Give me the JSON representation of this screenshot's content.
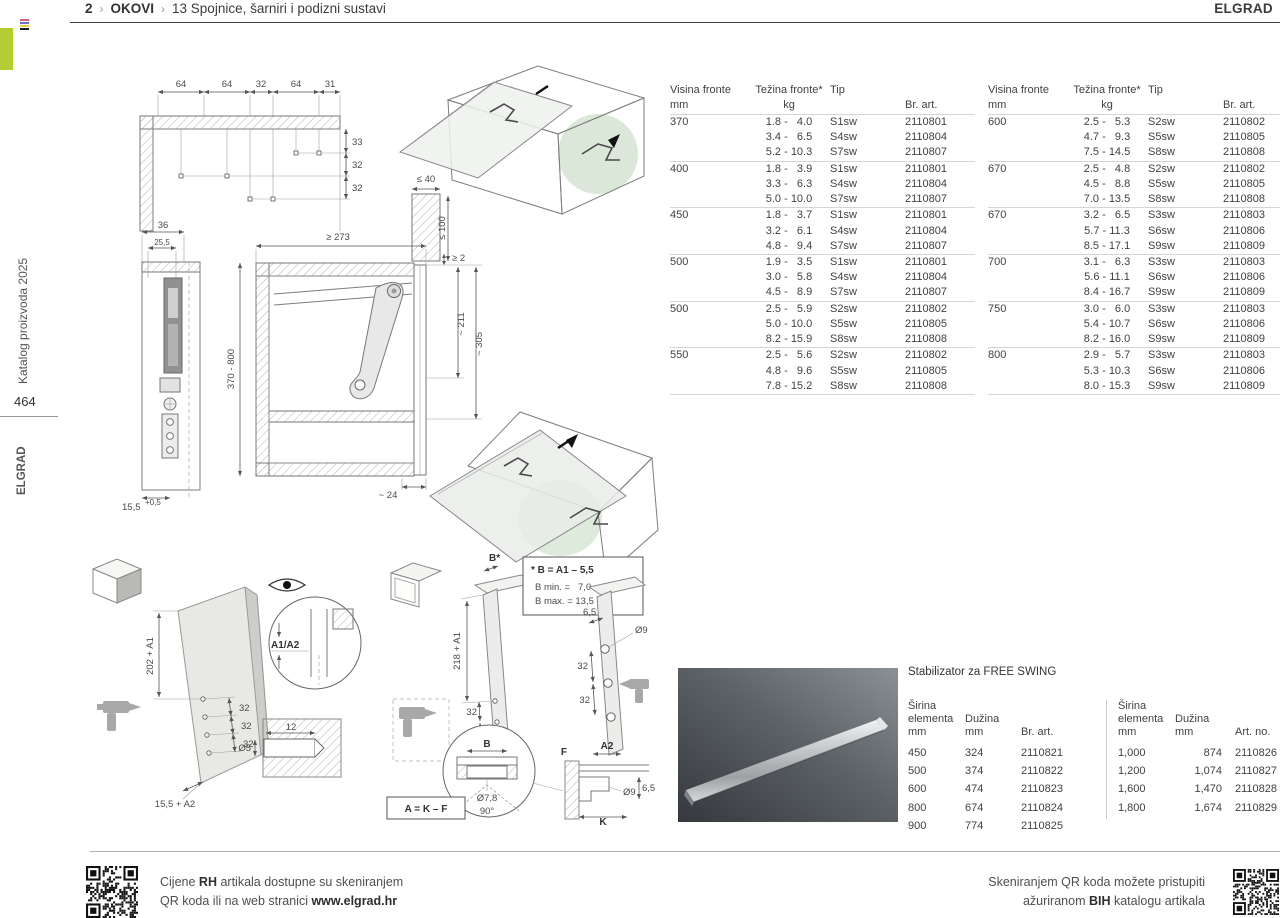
{
  "header": {
    "breadcrumb": {
      "page": "2",
      "sep1": "›",
      "section": "OKOVI",
      "sep2": "›",
      "title": "13  Spojnice, šarniri i podizni sustavi"
    },
    "brand": "ELGRAD"
  },
  "sidebar": {
    "catalog": "Katalog proizvoda 2025",
    "page_number": "464",
    "brand": "ELGRAD"
  },
  "hinge_tables": {
    "headers": {
      "visina": "Visina fronte",
      "visina_unit": "mm",
      "tezina": "Težina fronte*",
      "tezina_unit": "kg",
      "tip": "Tip",
      "art": "Br. art."
    },
    "left_groups": [
      {
        "visina": "370",
        "items": [
          [
            "1.8 -   4.0",
            "S1sw",
            "2110801"
          ],
          [
            "3.4 -   6.5",
            "S4sw",
            "2110804"
          ],
          [
            "5.2 - 10.3",
            "S7sw",
            "2110807"
          ]
        ]
      },
      {
        "visina": "400",
        "items": [
          [
            "1.8 -   3.9",
            "S1sw",
            "2110801"
          ],
          [
            "3.3 -   6.3",
            "S4sw",
            "2110804"
          ],
          [
            "5.0 - 10.0",
            "S7sw",
            "2110807"
          ]
        ]
      },
      {
        "visina": "450",
        "items": [
          [
            "1.8 -   3.7",
            "S1sw",
            "2110801"
          ],
          [
            "3.2 -   6.1",
            "S4sw",
            "2110804"
          ],
          [
            "4.8 -   9.4",
            "S7sw",
            "2110807"
          ]
        ]
      },
      {
        "visina": "500",
        "items": [
          [
            "1.9 -   3.5",
            "S1sw",
            "2110801"
          ],
          [
            "3.0 -   5.8",
            "S4sw",
            "2110804"
          ],
          [
            "4.5 -   8.9",
            "S7sw",
            "2110807"
          ]
        ]
      },
      {
        "visina": "500",
        "items": [
          [
            "2.5 -   5.9",
            "S2sw",
            "2110802"
          ],
          [
            "5.0 - 10.0",
            "S5sw",
            "2110805"
          ],
          [
            "8.2 - 15.9",
            "S8sw",
            "2110808"
          ]
        ]
      },
      {
        "visina": "550",
        "items": [
          [
            "2.5 -   5.6",
            "S2sw",
            "2110802"
          ],
          [
            "4.8 -   9.6",
            "S5sw",
            "2110805"
          ],
          [
            "7.8 - 15.2",
            "S8sw",
            "2110808"
          ]
        ]
      }
    ],
    "right_groups": [
      {
        "visina": "600",
        "items": [
          [
            "2.5 -   5.3",
            "S2sw",
            "2110802"
          ],
          [
            "4.7 -   9.3",
            "S5sw",
            "2110805"
          ],
          [
            "7.5 - 14.5",
            "S8sw",
            "2110808"
          ]
        ]
      },
      {
        "visina": "670",
        "items": [
          [
            "2.5 -   4.8",
            "S2sw",
            "2110802"
          ],
          [
            "4.5 -   8.8",
            "S5sw",
            "2110805"
          ],
          [
            "7.0 - 13.5",
            "S8sw",
            "2110808"
          ]
        ]
      },
      {
        "visina": "670",
        "items": [
          [
            "3.2 -   6.5",
            "S3sw",
            "2110803"
          ],
          [
            "5.7 - 11.3",
            "S6sw",
            "2110806"
          ],
          [
            "8.5 - 17.1",
            "S9sw",
            "2110809"
          ]
        ]
      },
      {
        "visina": "700",
        "items": [
          [
            "3.1 -   6.3",
            "S3sw",
            "2110803"
          ],
          [
            "5.6 - 11.1",
            "S6sw",
            "2110806"
          ],
          [
            "8.4 - 16.7",
            "S9sw",
            "2110809"
          ]
        ]
      },
      {
        "visina": "750",
        "items": [
          [
            "3.0 -   6.0",
            "S3sw",
            "2110803"
          ],
          [
            "5.4 - 10.7",
            "S6sw",
            "2110806"
          ],
          [
            "8.2 - 16.0",
            "S9sw",
            "2110809"
          ]
        ]
      },
      {
        "visina": "800",
        "items": [
          [
            "2.9 -   5.7",
            "S3sw",
            "2110803"
          ],
          [
            "5.3 - 10.3",
            "S6sw",
            "2110806"
          ],
          [
            "8.0 - 15.3",
            "S9sw",
            "2110809"
          ]
        ]
      }
    ]
  },
  "stabilizer": {
    "title": "Stabilizator za FREE SWING",
    "left_table": {
      "h_sirina_1": "Širina",
      "h_sirina_2": "elementa",
      "h_sirina_3": "mm",
      "h_duzina_1": "Dužina",
      "h_duzina_2": "mm",
      "h_art": "Br. art.",
      "rows": [
        [
          "450",
          "324",
          "2110821"
        ],
        [
          "500",
          "374",
          "2110822"
        ],
        [
          "600",
          "474",
          "2110823"
        ],
        [
          "800",
          "674",
          "2110824"
        ],
        [
          "900",
          "774",
          "2110825"
        ]
      ]
    },
    "right_table": {
      "h_sirina_1": "Širina",
      "h_sirina_2": "elementa",
      "h_sirina_3": "mm",
      "h_duzina_1": "Dužina",
      "h_duzina_2": "mm",
      "h_art": "Art. no.",
      "rows": [
        [
          "1,000",
          "874",
          "2110826"
        ],
        [
          "1,200",
          "1,074",
          "2110827"
        ],
        [
          "1,600",
          "1,470",
          "2110828"
        ],
        [
          "1,800",
          "1,674",
          "2110829"
        ]
      ]
    }
  },
  "drawings": {
    "corner": {
      "top": [
        "64",
        "64",
        "32",
        "64",
        "31"
      ],
      "right": [
        "33",
        "32",
        "32"
      ]
    },
    "side": {
      "d36": "36",
      "d255": "25,5",
      "d155": "15,5",
      "sup": "+0,5"
    },
    "front": {
      "width": "≥ 273",
      "height": "370 - 800",
      "wall": "≤ 40",
      "depth": "≤ 100",
      "gap": "≥ 2",
      "a211": "~ 211",
      "a305": "~ 305",
      "b24": "~ 24"
    },
    "drill_left": {
      "v": "202 + A1",
      "s1": "32",
      "s2": "32",
      "s3": "32",
      "bottom": "15,5 + A2",
      "detail": "A1/A2",
      "dia": "Ø5",
      "depth": "12"
    },
    "drill_mid": {
      "b": "B*",
      "note1": "* B = A1 – 5,5",
      "note2": "B min. =   7,0",
      "note3": "B max. = 13,5",
      "v": "218 + A1",
      "s1": "32",
      "s2": "32",
      "r_offset": "6,5",
      "r_dia": "Ø9",
      "r1": "32",
      "r2": "32",
      "c_b": "B",
      "c_dia": "Ø7,8",
      "c_ang": "90°",
      "a2": "A2",
      "f": "F",
      "k": "K",
      "d9": "Ø9",
      "h65": "6,5",
      "formula": "A = K – F"
    }
  },
  "footer": {
    "left1_pre": "Cijene ",
    "left1_bold": "RH",
    "left1_post": " artikala dostupne su skeniranjem",
    "left2_pre": "QR koda ili na web stranici ",
    "left2_bold": "www.elgrad.hr",
    "right1": "Skeniranjem QR koda možete pristupiti",
    "right2_pre": "ažuriranom ",
    "right2_bold": "BIH",
    "right2_post": " katalogu artikala"
  },
  "colors": {
    "accent_green": "#b5cd35",
    "highlight_green": "#c8dcc4"
  }
}
